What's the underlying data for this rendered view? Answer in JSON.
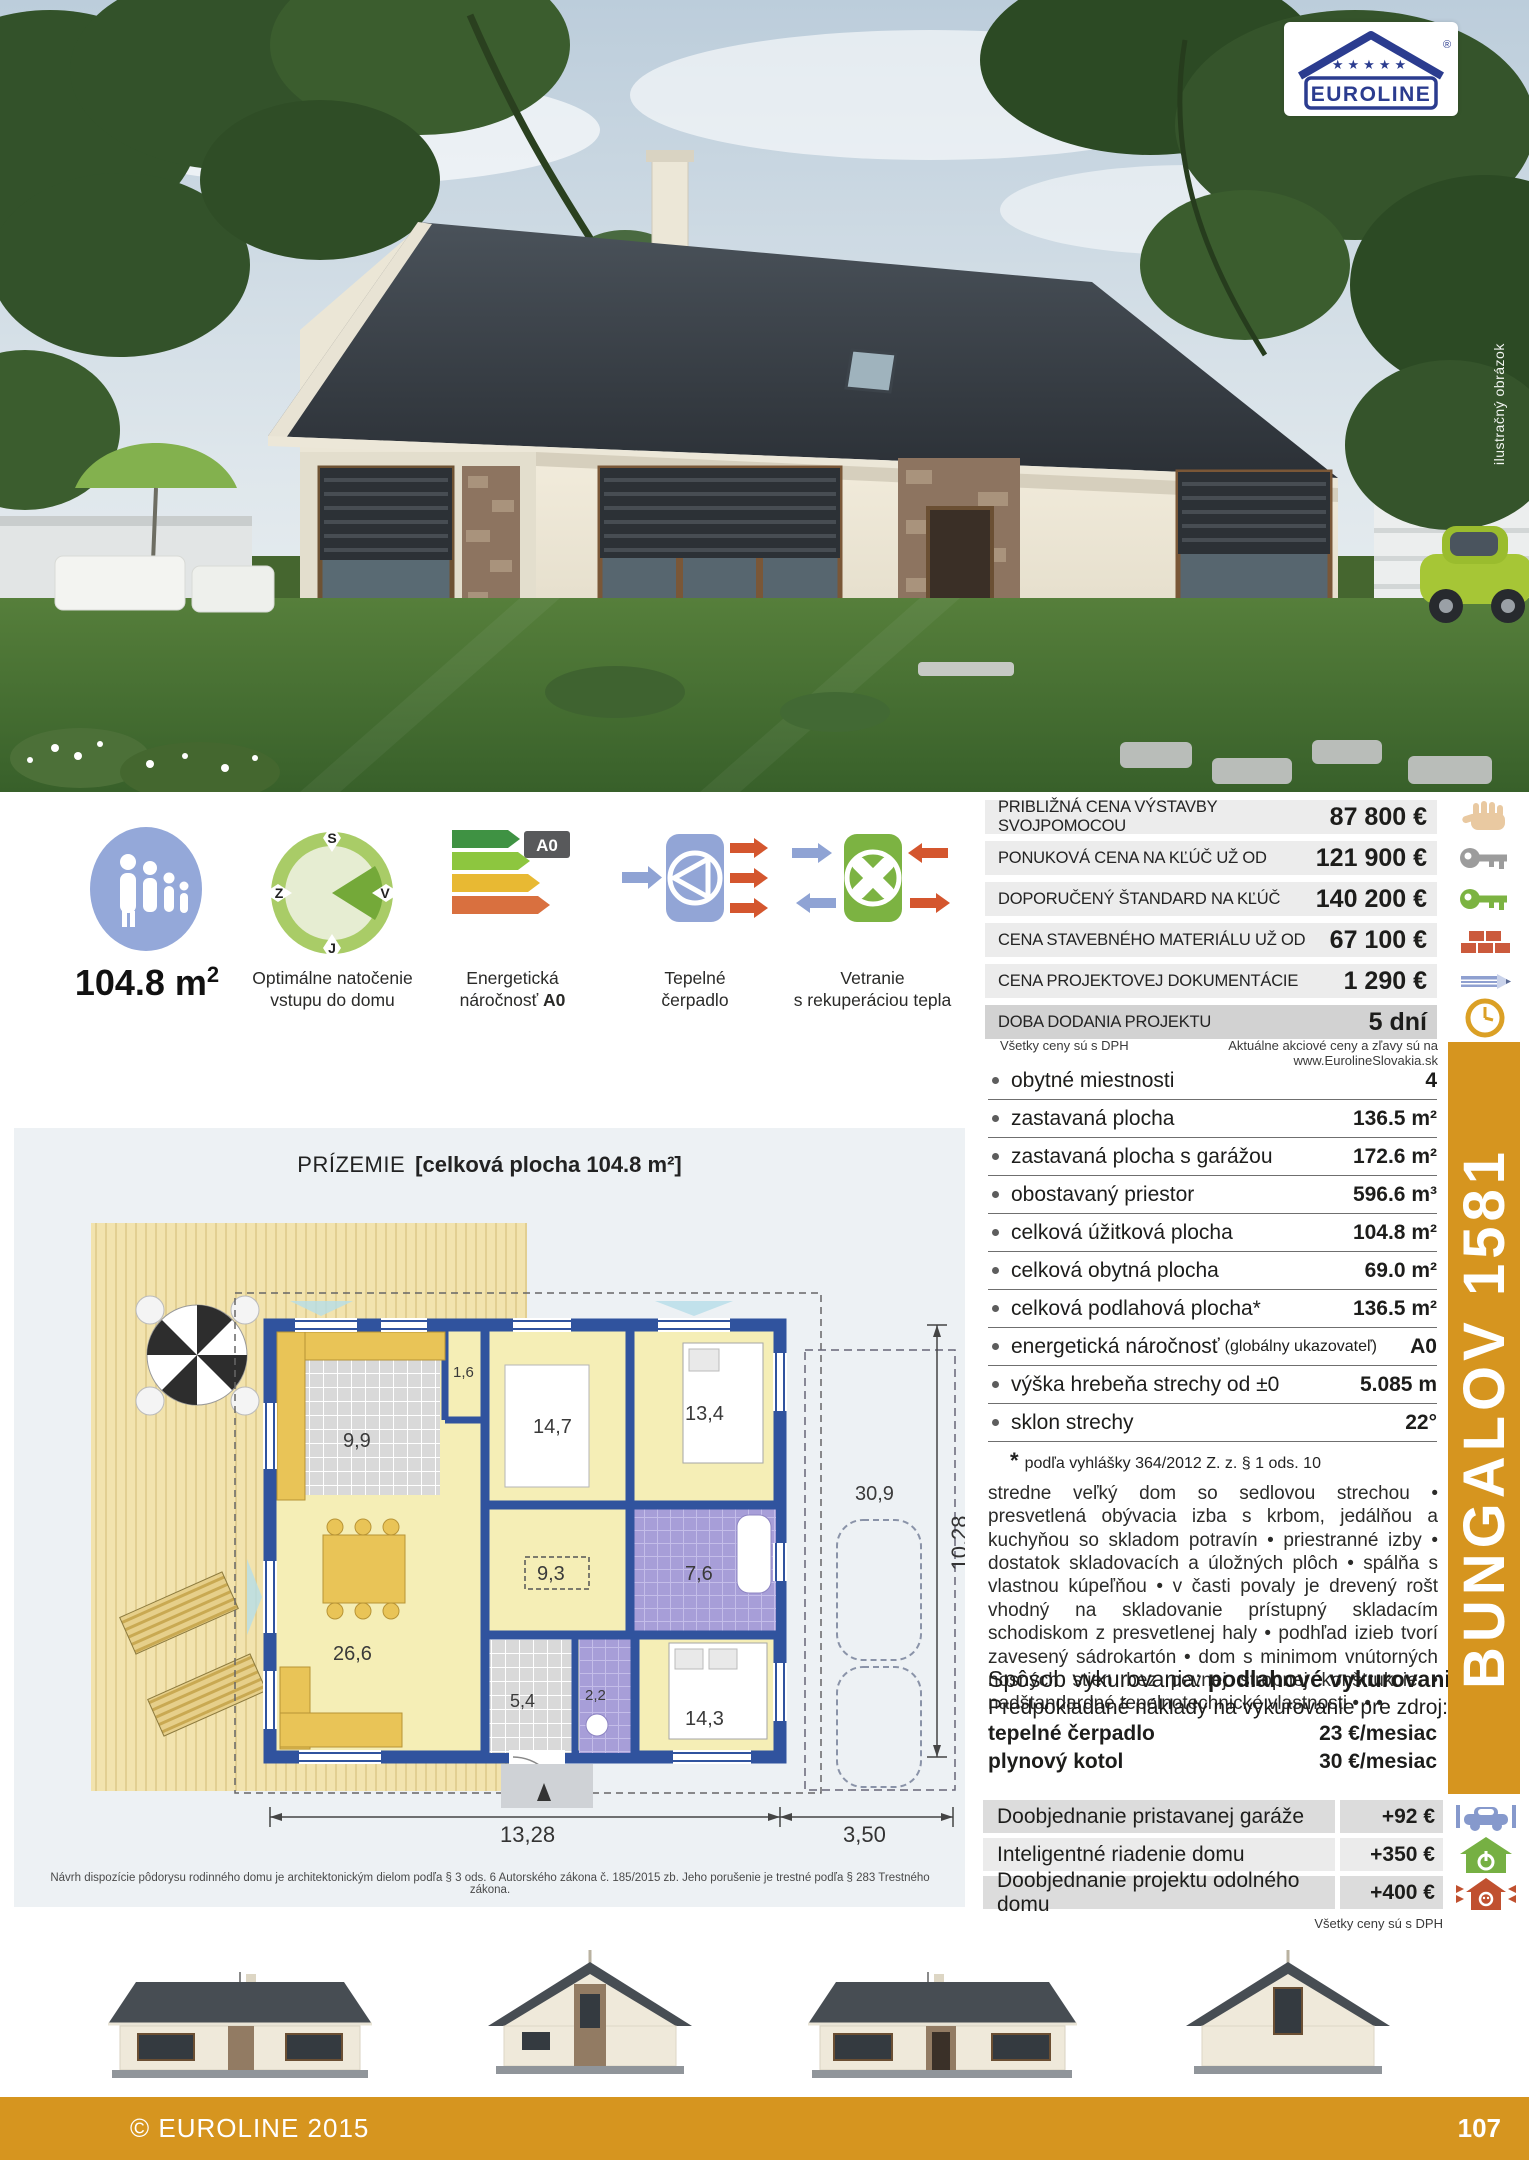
{
  "logo": {
    "brand": "EUROLINE",
    "registered": "®",
    "stars": "★★★★★"
  },
  "photo": {
    "vertical_caption": "ilustračný obrázok"
  },
  "area": {
    "value": "104.8 m",
    "sup": "2"
  },
  "features": {
    "compass": {
      "caption1": "Optimálne natočenie",
      "caption2": "vstupu do domu",
      "north": "S",
      "west": "Z",
      "east": "V",
      "south": "J"
    },
    "energy": {
      "caption1": "Energetická",
      "caption2": "náročnosť ",
      "caption2_bold": "A0",
      "badge": "A0"
    },
    "pump": {
      "caption1": "Tepelné",
      "caption2": "čerpadlo"
    },
    "vent": {
      "caption1": "Vetranie",
      "caption2": "s rekuperáciou tepla"
    }
  },
  "price_table": {
    "rows": [
      {
        "label": "PRIBLIŽNÁ CENA VÝSTAVBY SVOJPOMOCOU",
        "value": "87 800 €",
        "icon": "hand-icon"
      },
      {
        "label": "PONUKOVÁ CENA NA KĽÚČ UŽ OD",
        "value": "121 900 €",
        "icon": "key-gray-icon"
      },
      {
        "label": "DOPORUČENÝ ŠTANDARD NA KĽÚČ",
        "value": "140 200 €",
        "icon": "key-green-icon"
      },
      {
        "label": "CENA STAVEBNÉHO MATERIÁLU UŽ OD",
        "value": "67 100 €",
        "icon": "bricks-icon"
      },
      {
        "label": "CENA PROJEKTOVEJ DOKUMENTÁCIE",
        "value": "1 290 €",
        "icon": "pencil-icon"
      },
      {
        "label": "DOBA DODANIA PROJEKTU",
        "value": "5 dní",
        "icon": "clock-icon"
      }
    ],
    "note_left": "Všetky ceny sú s DPH",
    "note_right": "Aktuálne akciové ceny a zľavy sú na www.EurolineSlovakia.sk"
  },
  "specs": {
    "rows": [
      {
        "label": "obytné miestnosti",
        "note": "",
        "value": "4"
      },
      {
        "label": "zastavaná plocha",
        "note": "",
        "value": "136.5 m²"
      },
      {
        "label": "zastavaná plocha s garážou",
        "note": "",
        "value": "172.6 m²"
      },
      {
        "label": "obostavaný priestor",
        "note": "",
        "value": "596.6 m³"
      },
      {
        "label": "celková úžitková plocha",
        "note": "",
        "value": "104.8 m²"
      },
      {
        "label": "celková obytná plocha",
        "note": "",
        "value": "69.0 m²"
      },
      {
        "label": "celková podlahová plocha*",
        "note": "",
        "value": "136.5 m²"
      },
      {
        "label": "energetická náročnosť",
        "note": "(globálny ukazovateľ)",
        "value": "A0"
      },
      {
        "label": "výška hrebeňa strechy od ±0",
        "note": "",
        "value": "5.085 m"
      },
      {
        "label": "sklon strechy",
        "note": "",
        "value": "22°"
      }
    ],
    "footnote_star": "*",
    "footnote_text": "podľa vyhlášky 364/2012 Z. z. § 1 ods. 10"
  },
  "description": "stredne veľký dom so sedlovou strechou • presvetlená obývacia izba s krbom, jedálňou a kuchyňou so skladom potravín • priestranné izby • dostatok skladovacích a úložných plôch • spálňa s vlastnou kúpeľňou • v časti povaly je drevený rošt vhodný na skladovanie prístupný skladacím schodiskom z presvetlenej haly • podhľad izieb tvorí zavesený sádrokartón • dom s minimom vnútorných nosných stien bez pevnej stropnej konštrukcie • nadštandardné tepelnotechnické vlastnosti • • •",
  "heating": {
    "prefix": "Spôsob vykurovania: ",
    "method": "podlahové vykurovanie",
    "line2": "Predpokladané náklady na vykurovanie pre zdroj:",
    "rows": [
      {
        "label": "tepelné čerpadlo",
        "value": "23 €/mesiac"
      },
      {
        "label": "plynový kotol",
        "value": "30 €/mesiac"
      }
    ]
  },
  "options": {
    "rows": [
      {
        "label": "Doobjednanie pristavanej garáže",
        "value": "+92 €",
        "icon": "car-icon"
      },
      {
        "label": "Inteligentné riadenie domu",
        "value": "+350 €",
        "icon": "smart-home-icon"
      },
      {
        "label": "Doobjednanie projektu odolného domu",
        "value": "+400 €",
        "icon": "resilient-house-icon"
      }
    ],
    "note": "Všetky ceny sú s DPH"
  },
  "sidebar": {
    "model": "BUNGALOV 1581"
  },
  "plan": {
    "title": "PRÍZEMIE",
    "subtitle": "[celková plocha 104.8 m²]",
    "rooms": [
      "9,9",
      "1,6",
      "14,7",
      "13,4",
      "9,3",
      "7,6",
      "26,6",
      "5,4",
      "2,2",
      "14,3"
    ],
    "dims": {
      "bottom_main": "13,28",
      "bottom_garage": "3,50",
      "side": "10,28",
      "garage_area": "30,9"
    }
  },
  "disclaimer": "Návrh dispozície pôdorysu rodinného domu je architektonickým dielom podľa § 3 ods. 6 Autorského zákona č. 185/2015 zb. Jeho porušenie je trestné podľa § 283 Trestného zákona.",
  "footer": {
    "copyright": "© EUROLINE 2015",
    "page": "107"
  }
}
